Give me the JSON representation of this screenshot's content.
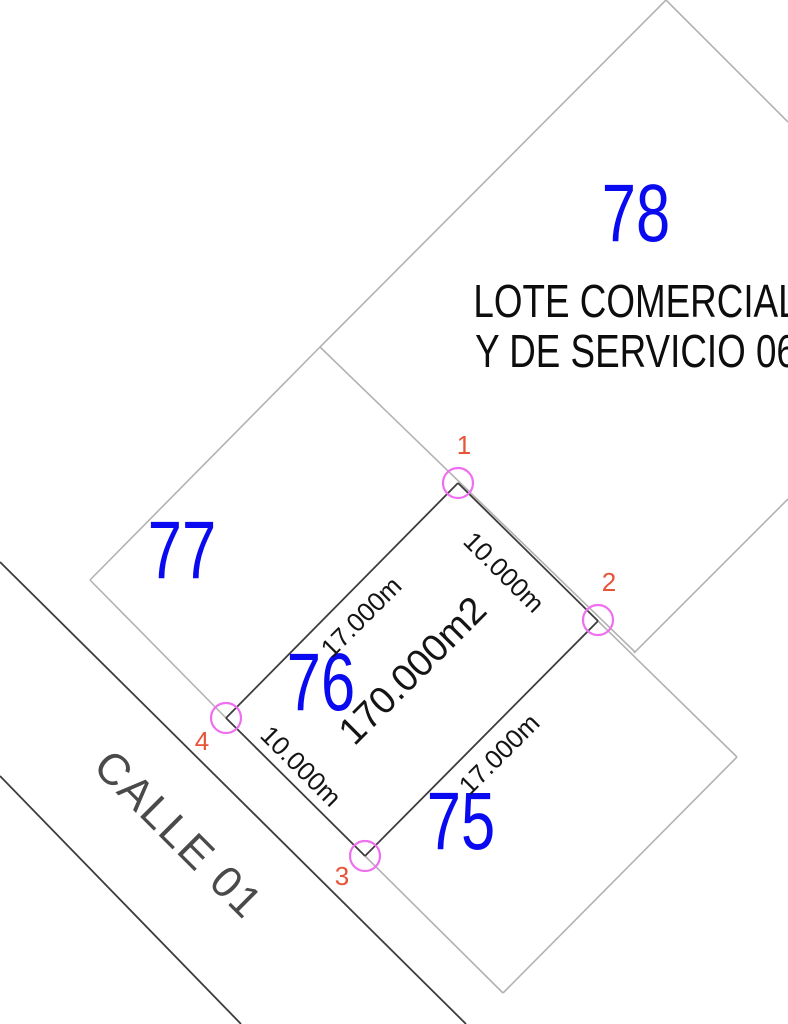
{
  "colors": {
    "background": "#ffffff",
    "lot_number": "#0a0af0",
    "lot_name": "#0d0d0d",
    "area_text": "#141414",
    "dimension_text": "#141414",
    "vertex_label": "#e85439",
    "vertex_marker": "#f06ef0",
    "line_dark": "#3c3c3c",
    "line_light": "#b2b2b2",
    "street_text": "#4a4a4a"
  },
  "lots": [
    {
      "number": "78",
      "name_line1": "LOTE COMERCIAL",
      "name_line2": "Y DE SERVICIO 06"
    },
    {
      "number": "77"
    },
    {
      "number": "76",
      "area": "170.000m2"
    },
    {
      "number": "75"
    }
  ],
  "street": {
    "name": "CALLE 01"
  },
  "dimensions": [
    {
      "edge": "1-2",
      "label": "10.000m"
    },
    {
      "edge": "4-1",
      "label": "17.000m"
    },
    {
      "edge": "4-3",
      "label": "10.000m"
    },
    {
      "edge": "3-2",
      "label": "17.000m"
    }
  ],
  "vertices": [
    {
      "label": "1"
    },
    {
      "label": "2"
    },
    {
      "label": "3"
    },
    {
      "label": "4"
    }
  ]
}
